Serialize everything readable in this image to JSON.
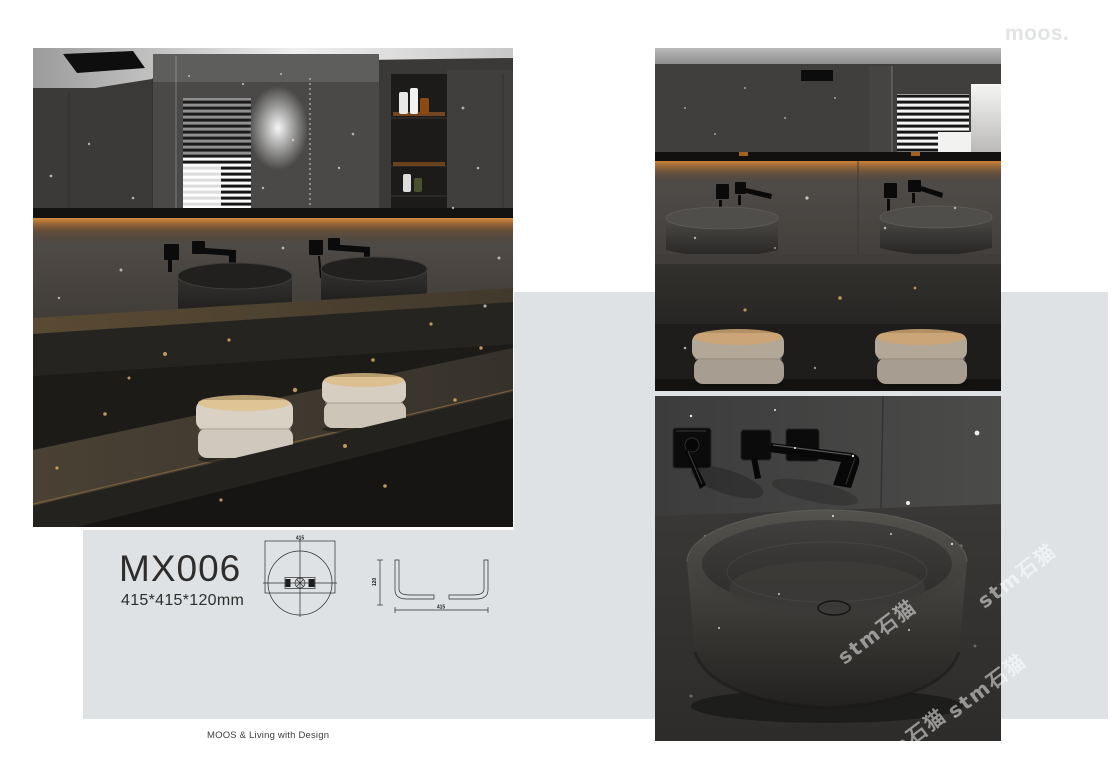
{
  "brand": {
    "logo_text": "moos.",
    "tagline": "MOOS & Living with Design"
  },
  "product": {
    "code": "MX006",
    "dimensions": "415*415*120mm"
  },
  "technical_drawing": {
    "top_width_label": "415",
    "side_height_label": "120",
    "side_width_label": "415"
  },
  "watermark": {
    "text": "stm石猫"
  },
  "colors": {
    "page_bg": "#ffffff",
    "panel_gray": "#dee2e5",
    "text_dark": "#2e2d2b",
    "logo_gray": "#e2e3e4",
    "glow_orange": "#c07a2e",
    "photo_base": "#383736"
  }
}
